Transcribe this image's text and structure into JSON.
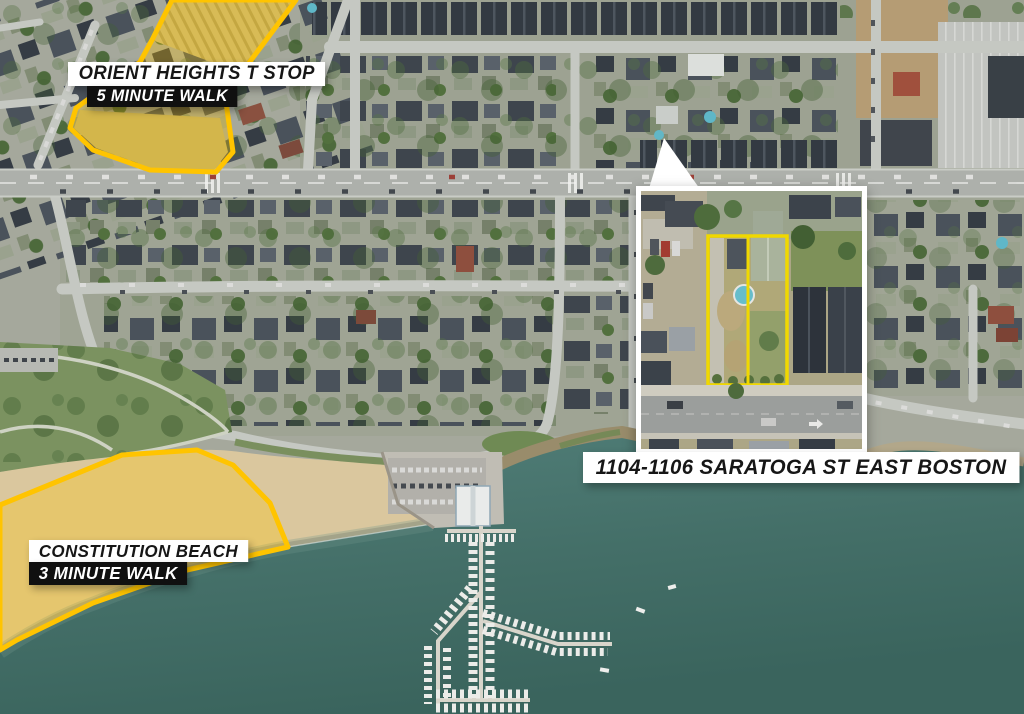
{
  "annotations": {
    "orient_heights": {
      "title": "ORIENT HEIGHTS T STOP",
      "subtitle": "5 MINUTE WALK"
    },
    "constitution_beach": {
      "title": "CONSTITUTION BEACH",
      "subtitle": "3 MINUTE WALK"
    },
    "property": {
      "address": "1104-1106 SARATOGA ST EAST BOSTON"
    }
  },
  "theme": {
    "highlight_yellow": "#FFC400",
    "property_outline_yellow": "#F0D800",
    "water_teal": "#446F68",
    "sand_tan": "#DAC79E",
    "label_light_bg": "#FFFFFF",
    "label_dark_bg": "#101010",
    "label_text_on_light": "#161616",
    "label_text_on_dark": "#FFFFFF"
  }
}
